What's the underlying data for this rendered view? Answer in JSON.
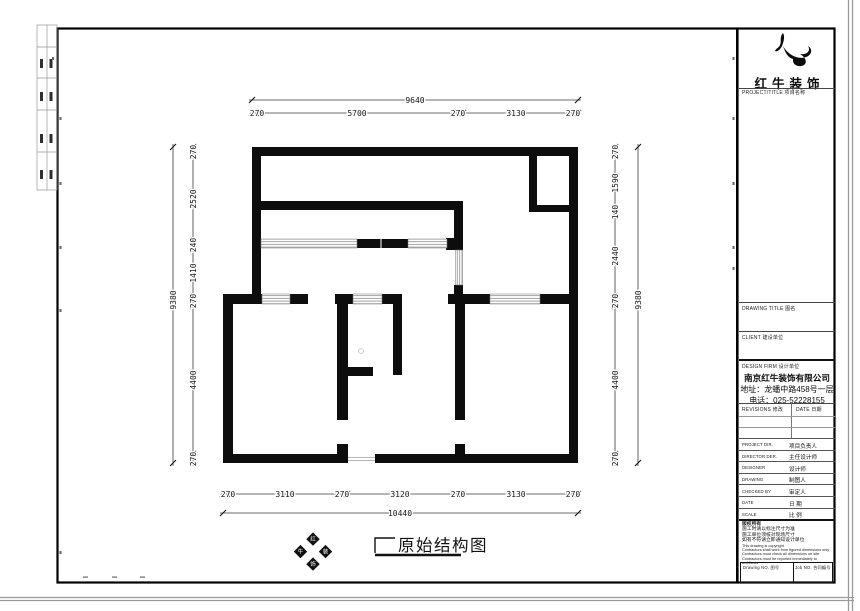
{
  "dims": {
    "top_overall": "9640",
    "top_chain": [
      "270",
      "5700",
      "270",
      "3130",
      "270"
    ],
    "bottom_chain": [
      "270",
      "3110",
      "270",
      "3120",
      "270",
      "3130",
      "270"
    ],
    "bottom_overall": "10440",
    "left_overall": "9380",
    "left_chain": [
      "270",
      "2520",
      "240",
      "1410",
      "270",
      "4400",
      "270"
    ],
    "right_chain": [
      "270",
      "1590",
      "140",
      "2440",
      "270",
      "4400",
      "270"
    ],
    "right_overall": "9380"
  },
  "drawing": {
    "title": "原始结构图",
    "stamp": [
      "红",
      "牛",
      "装",
      "饰"
    ]
  },
  "title_block": {
    "logo_text": "红牛装饰",
    "project_title_label": "PROJECT/TITLE 项目名称",
    "drawing_title_label": "DRAWING TITLE 图名",
    "client_label": "CLIENT 建设单位",
    "design_firm_label": "DESIGN FIRM 设计单位",
    "company_name": "南京红牛装饰有限公司",
    "company_address": "地址：龙蟠中路458号一层",
    "company_phone": "电话：025-52228155",
    "revisions_label": "REVISIONS 修改",
    "date_label": "DATE 日期",
    "rows": [
      {
        "en": "PROJECT DIR.",
        "cn": "项目负责人"
      },
      {
        "en": "DIRECTOR DER.",
        "cn": "主任设计师"
      },
      {
        "en": "DESIGNER",
        "cn": "设计师"
      },
      {
        "en": "DRAWING",
        "cn": "制图人"
      },
      {
        "en": "CHECKED BY",
        "cn": "审定人"
      },
      {
        "en": "DATE",
        "cn": "日 期"
      },
      {
        "en": "SCALE",
        "cn": "比 例"
      }
    ],
    "notes_cn": [
      "版权所有",
      "施工时请以标注尺寸为准",
      "施工单位须核对现场尺寸",
      "如有不符请立即通知设计单位"
    ],
    "notes_en": [
      "This drawing is copyright",
      "Contractors shall work from figured dimensions only",
      "Contractors must check all dimensions on site",
      "Contractors must be reported immediately to architects"
    ],
    "drawing_no_label": "Drawing NO. 图号",
    "job_no_label": "Job NO. 合同编号"
  }
}
